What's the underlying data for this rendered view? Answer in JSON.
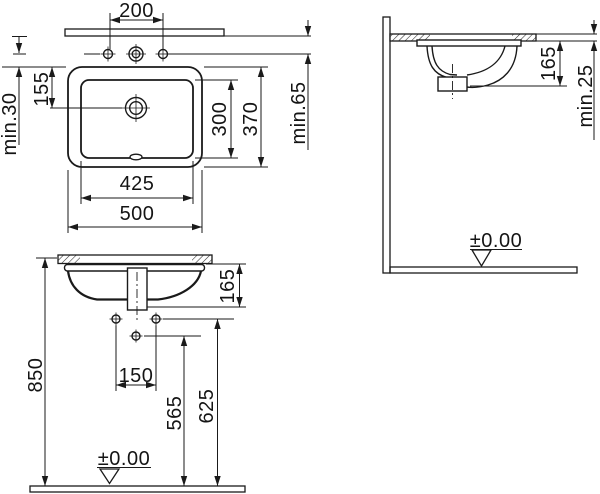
{
  "colors": {
    "line": "#1a1a1a",
    "background": "#ffffff"
  },
  "plan_view": {
    "tap_hole_spacing": "200",
    "edge_to_tap_center": "155",
    "min_hole_to_cutout": "min.30",
    "inner_depth": "300",
    "overall_depth": "370",
    "min_wall_to_hole": "min.65",
    "inner_width": "425",
    "overall_width": "500"
  },
  "side_view": {
    "basin_depth": "165",
    "min_counter_thickness": "min.25",
    "floor_datum": "±0.00"
  },
  "front_view": {
    "basin_depth": "165",
    "fixing_hole_spacing": "150",
    "height_center_hole": "565",
    "height_fixing_holes": "625",
    "counter_height": "850",
    "floor_datum": "±0.00"
  }
}
